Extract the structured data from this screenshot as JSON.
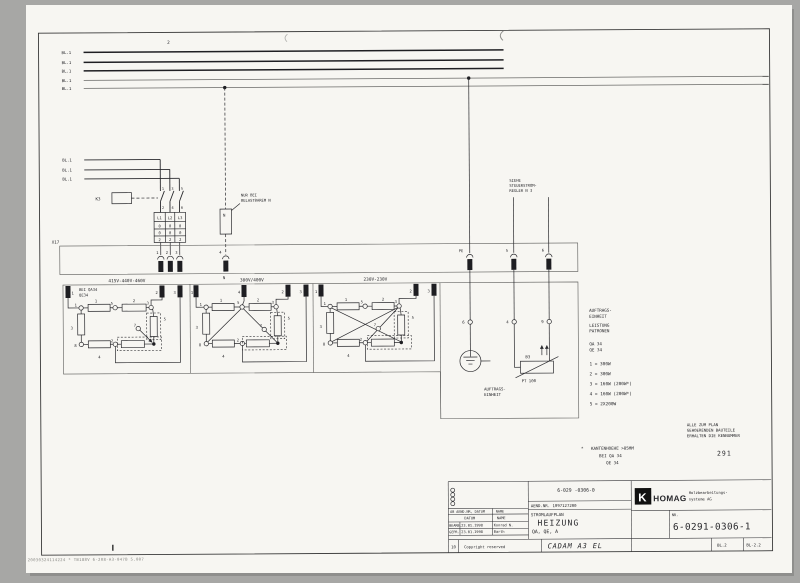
{
  "colors": {
    "paper": "#f7f6f2",
    "background": "#a7a7a5",
    "ink": "#26262a",
    "frame": "#3a3a3a"
  },
  "page": {
    "ref_top": "2"
  },
  "bus": {
    "labels": [
      "BL.1",
      "BL.1",
      "BL.1",
      "BL.1",
      "BL.1"
    ]
  },
  "feeder": {
    "labels": [
      "BL.1",
      "BL.1",
      "BL.1"
    ],
    "contactor": "K3",
    "pins_top": [
      "1",
      "3",
      "5"
    ],
    "pins_bottom": [
      "2",
      "4",
      "6"
    ],
    "block_header": [
      "L1",
      "L2",
      "L3"
    ],
    "block_rows": [
      [
        "0",
        "0",
        "0"
      ],
      [
        "0",
        "0",
        "0"
      ],
      [
        "2",
        "2",
        "2"
      ]
    ],
    "strip": "X17"
  },
  "band": {
    "pins": [
      "1",
      "2",
      "3"
    ],
    "n_pin": "4",
    "n_label": "N",
    "pe": "PE",
    "pin5": "5",
    "pin6": "6"
  },
  "notes": {
    "nur_bei": [
      "NUR BEI",
      "BELASTBAREM N"
    ],
    "n_box": "N",
    "siehe": [
      "SIEHE",
      "STEUERSTROM-",
      "REGLER N 3"
    ],
    "auftrags": [
      "AUFTRAGS-",
      "EINHEIT"
    ],
    "alle": [
      "ALLE ZUM PLAN",
      "GEHOERENDEN BAUTEILE",
      "ERHALTEN DIE KENNUMMER"
    ],
    "kennummer": "291",
    "kante_star": "*",
    "kante": [
      "KANTENHOEHE >85MM",
      "BEI QA 34",
      "QE 34"
    ]
  },
  "sections": [
    {
      "title": "415V-440V-460V",
      "note": [
        "BEI QA34",
        "QE34"
      ],
      "terminals": {
        "t1": "1",
        "t2": "2",
        "t3": "3"
      },
      "resistors": {
        "r1": "1",
        "r2": "2",
        "r3": "3",
        "r4": "4",
        "r5": "5"
      },
      "nodes": {
        "n1": "1",
        "n2": "2",
        "n3": "3",
        "n5": "5",
        "n7": "7",
        "n8": "8"
      }
    },
    {
      "title": "380V/400V",
      "terminals": {
        "t1": "1",
        "t4": "4",
        "t2": "2",
        "t3": "3"
      },
      "resistors": {
        "r1": "1",
        "r2": "2",
        "r3": "3",
        "r4": "4",
        "r5": "5"
      },
      "nodes": {
        "n1": "1",
        "n2": "2",
        "n3": "3",
        "n5": "5",
        "n7": "7",
        "n8": "8"
      }
    },
    {
      "title": "230V-230V",
      "terminals": {
        "t1": "1",
        "t2": "2",
        "t3": "3"
      },
      "resistors": {
        "r1": "1",
        "r2": "2",
        "r3": "3",
        "r4": "4",
        "r5": "5"
      },
      "nodes": {
        "n1": "1",
        "n2": "2",
        "n3": "3",
        "n5": "5",
        "n7": "7",
        "n8": "8"
      }
    }
  ],
  "right": {
    "c6": "6",
    "c4": "4",
    "c9": "9",
    "sensor": "B3",
    "sensor_type": "PT 100"
  },
  "legend": {
    "header": [
      "AUFTRAGS-",
      "EINHEIT"
    ],
    "sub": [
      "LEISTUNG",
      "PATRONEN"
    ],
    "units": [
      "QA 34",
      "QE 34"
    ],
    "items": [
      "1 = 300W",
      "2 = 300W",
      "3 = 160W (200W*)",
      "4 = 160W (200W*)",
      "5 = 2X200W"
    ]
  },
  "titleblock": {
    "doc_no": "6-029 -0306-0",
    "rev_header": "AB AEND.NR, DATUM",
    "rev_name": "NAME",
    "aend_nr": "AEND.NR. 1097127200",
    "plan_type": "STROMLAUFPLAN",
    "title": "HEIZUNG",
    "subtitle": "QA, QE, A",
    "col_datum": "DATUM",
    "col_name": "NAME",
    "row1_label": "BEARB.",
    "row1_date": "23.01.1998",
    "row1_name": "Konrad N.",
    "row2_label": "GEPR.",
    "row2_date": "23.01.1998",
    "row2_name": "Barth",
    "cell_10": "10",
    "copyright": "Copyright reserved",
    "cad_system": "CADAM A3 EL",
    "logo_glyph": "K",
    "brand": "HOMAG",
    "company_line1": "Holzbearbeitungs-",
    "company_line2": "systeme AG",
    "nr_label": "NR.",
    "drawing_no": "6-0291-0306-1",
    "sheet": "BL.2",
    "sheet_ref": "BL-2.2"
  },
  "footer": {
    "code": "20030324114224 * TB188V 6-208-A3-047B 5.007"
  }
}
